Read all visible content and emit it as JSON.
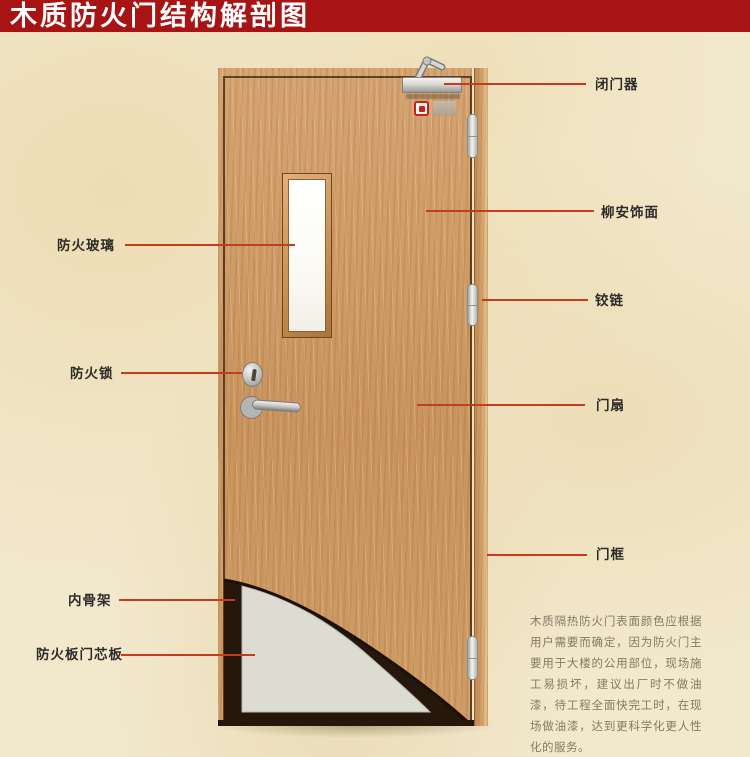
{
  "title": "木质防火门结构解剖图",
  "labels": {
    "fire_glass": "防火玻璃",
    "fire_lock": "防火锁",
    "inner_frame": "内骨架",
    "core_panel": "防火板门芯板",
    "door_closer": "闭门器",
    "veneer": "柳安饰面",
    "hinge": "铰链",
    "door_leaf": "门扇",
    "door_frame": "门框"
  },
  "description": "木质隔热防火门表面颜色应根据用户需要而确定，因为防火门主要用于大楼的公用部位，现场施工易损坏，建议出厂时不做油漆，待工程全面快完工时，在现场做油漆，达到更科学化更人性化的服务。",
  "colors": {
    "banner": "#a81414",
    "leader_line": "#c43b1e",
    "wood": "#cf9c66",
    "core_panel": "#dcdcd2",
    "cutaway_dark": "#26170c"
  }
}
